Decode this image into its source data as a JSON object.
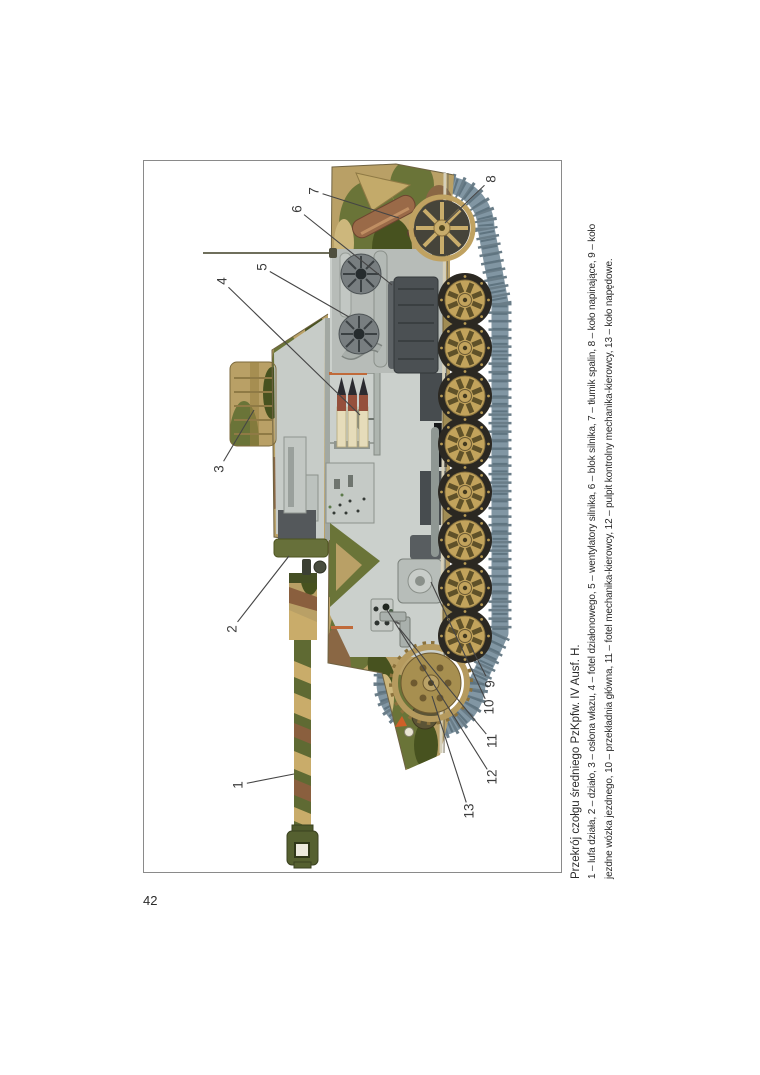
{
  "page_number": "42",
  "figure": {
    "caption": {
      "title": "Przekrój czołgu średniego PzKpfw. IV Ausf. H.",
      "line2": "1 – lufa działa, 2 – działo, 3 – osłona włazu, 4 – fotel działonowego, 5 – wentylatory silnika, 6 – blok silnika, 7 – tłumik spalin, 8 – koło napinające, 9 – koło",
      "line3": "jezdne wózka jezdnego, 10 – przekładnia główna, 11 – fotel mechanika-kierowcy, 12 – pulpit kontrolny mechanika-kierowcy, 13 – koło napędowe."
    },
    "labels": [
      {
        "num": "1",
        "x": 88,
        "y": 94,
        "tx": 99,
        "ty": 150
      },
      {
        "num": "2",
        "x": 244,
        "y": 88,
        "tx": 317,
        "ty": 145
      },
      {
        "num": "3",
        "x": 404,
        "y": 75,
        "tx": 463,
        "ty": 110
      },
      {
        "num": "4",
        "x": 592,
        "y": 78,
        "tx": 458,
        "ty": 216
      },
      {
        "num": "5",
        "x": 606,
        "y": 118,
        "tx": 556,
        "ty": 205
      },
      {
        "num": "6",
        "x": 664,
        "y": 153,
        "tx": 588,
        "ty": 248
      },
      {
        "num": "7",
        "x": 682,
        "y": 170,
        "tx": 655,
        "ty": 255
      },
      {
        "num": "8",
        "x": 694,
        "y": 347,
        "tx": 650,
        "ty": 301
      },
      {
        "num": "9",
        "x": 189,
        "y": 346,
        "tx": 230,
        "ty": 325
      },
      {
        "num": "10",
        "x": 166,
        "y": 345,
        "tx": 291,
        "ty": 287
      },
      {
        "num": "11",
        "x": 132,
        "y": 348,
        "tx": 245,
        "ty": 255
      },
      {
        "num": "12",
        "x": 96,
        "y": 348,
        "tx": 263,
        "ty": 243
      },
      {
        "num": "13",
        "x": 62,
        "y": 325,
        "tx": 177,
        "ty": 288
      }
    ],
    "colors": {
      "camo_tan": "#b9a066",
      "camo_olive": "#6a7438",
      "camo_dark": "#47521f",
      "camo_brown": "#8a6744",
      "track": "#8196a3",
      "wheel_tan": "#c2a35c",
      "interior_gray": "#cbd0cc",
      "muffler": "#9a6a48",
      "accent_orange": "#c06a3a",
      "leader_line": "#454545"
    }
  }
}
